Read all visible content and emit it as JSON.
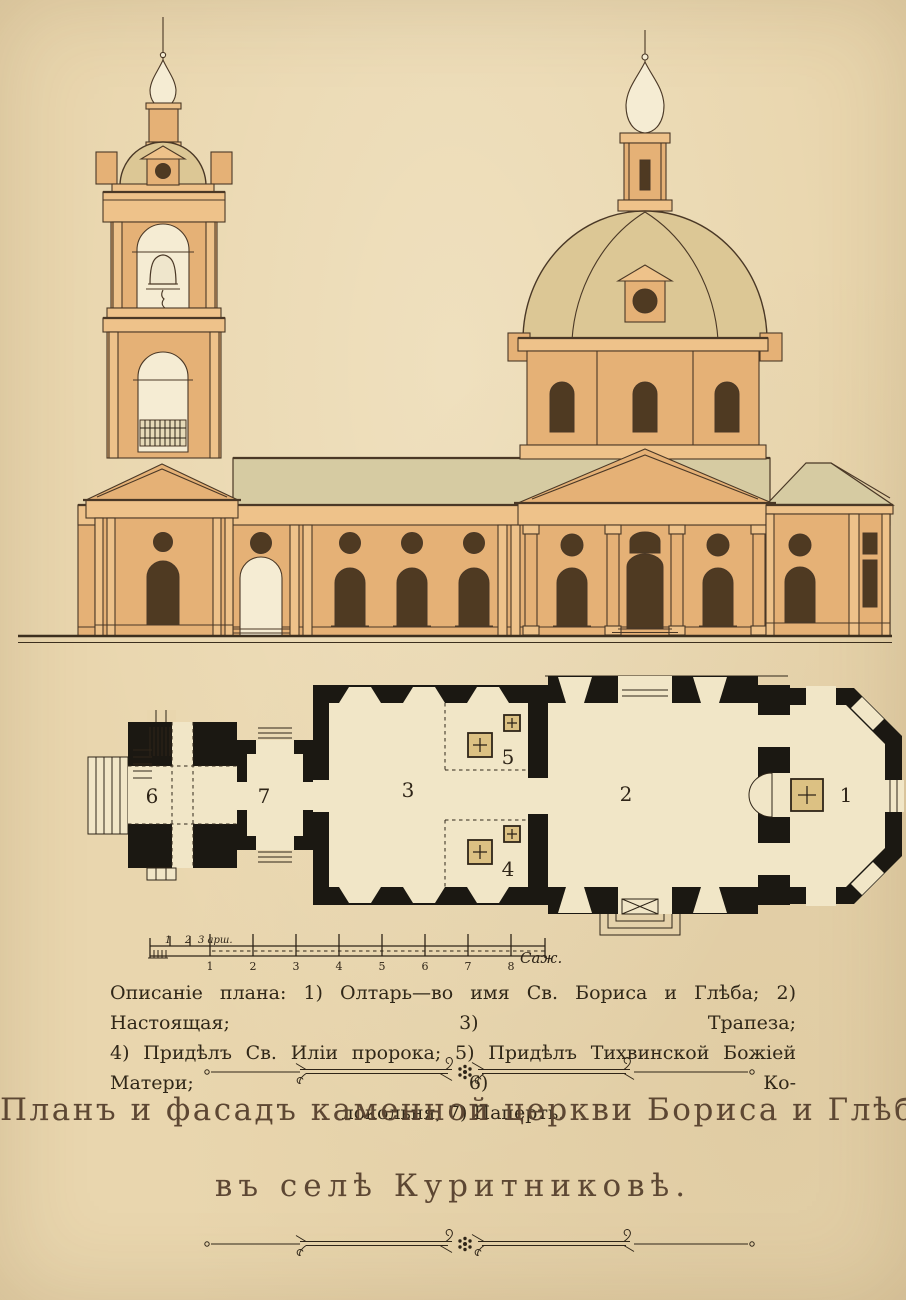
{
  "plan": {
    "room_labels": [
      "1",
      "2",
      "3",
      "4",
      "5",
      "6",
      "7"
    ]
  },
  "scale_bar": {
    "arshin_ticks": [
      "1",
      "2",
      "3 арш."
    ],
    "sazhen_ticks": [
      "1",
      "2",
      "3",
      "4",
      "5",
      "6",
      "7",
      "8"
    ],
    "unit_label": "Саж."
  },
  "caption": {
    "line1": "Описаніе плана: 1) Олтарь—во имя Св. Бориса и Глѣба; 2) Настоящая; 3) Трапеза;",
    "line2": "4) Придѣлъ Св. Иліи пророка; 5) Придѣлъ Тихвинской Божіей Матери; 6) Ко-",
    "line3": "локольня; 7) Паперть.",
    "ref_numbers": [
      "1",
      "2",
      "3",
      "4",
      "5",
      "6",
      "7"
    ]
  },
  "title": {
    "line1": "Планъ и фасадъ каменной церкви Бориса и Глѣба",
    "line2": "въ селѣ Куритниковѣ."
  },
  "colors": {
    "paper": "#e9d6ae",
    "ink": "#4a3826",
    "ink_dark": "#2f2518",
    "facade_wall": "#e5b176",
    "facade_light": "#eec28a",
    "roof": "#d6cba2",
    "dome": "#dcc795",
    "window_dark": "#4f3a22",
    "door_white": "#f5ecd3",
    "plan_black": "#1b1812",
    "plan_floor": "#f1e6c7",
    "altar_fill": "#dcc183",
    "title_ink": "#5d4733",
    "caption_ink": "#302718"
  }
}
